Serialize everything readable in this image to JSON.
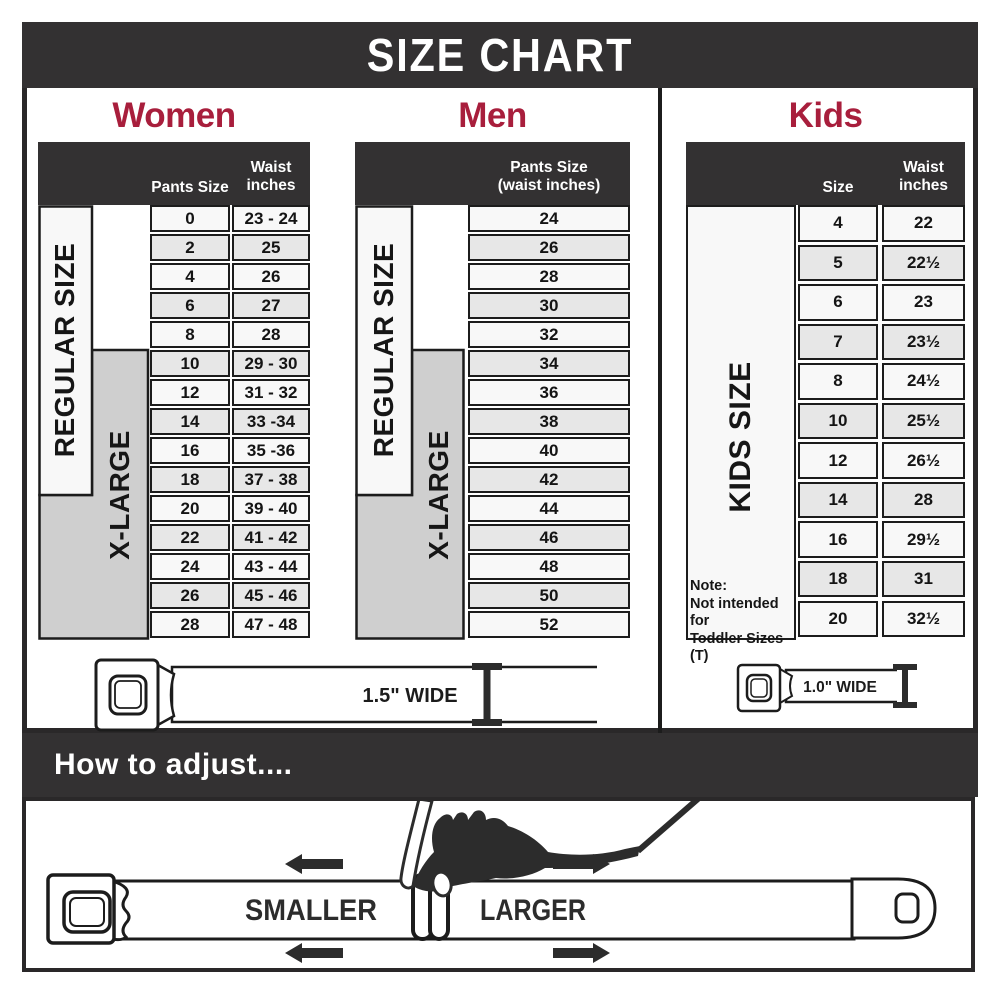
{
  "title": "SIZE CHART",
  "colors": {
    "accent": "#a81e3c",
    "band_dark": "#333132",
    "table_border": "#1c1c1c",
    "xlarge_gray": "#cfcfcf"
  },
  "women": {
    "heading": "Women",
    "regular_label": "REGULAR SIZE",
    "xlarge_label": "X-LARGE",
    "col_size_header": "Pants Size",
    "waist_header_line1": "Waist",
    "waist_header_line2": "inches",
    "rows": [
      {
        "size": "0",
        "waist": "23 - 24"
      },
      {
        "size": "2",
        "waist": "25"
      },
      {
        "size": "4",
        "waist": "26"
      },
      {
        "size": "6",
        "waist": "27"
      },
      {
        "size": "8",
        "waist": "28"
      },
      {
        "size": "10",
        "waist": "29 - 30"
      },
      {
        "size": "12",
        "waist": "31 - 32"
      },
      {
        "size": "14",
        "waist": "33 -34"
      },
      {
        "size": "16",
        "waist": "35 -36"
      },
      {
        "size": "18",
        "waist": "37 - 38"
      },
      {
        "size": "20",
        "waist": "39 - 40"
      },
      {
        "size": "22",
        "waist": "41 - 42"
      },
      {
        "size": "24",
        "waist": "43 - 44"
      },
      {
        "size": "26",
        "waist": "45 - 46"
      },
      {
        "size": "28",
        "waist": "47 - 48"
      }
    ]
  },
  "men": {
    "heading": "Men",
    "regular_label": "REGULAR SIZE",
    "xlarge_label": "X-LARGE",
    "header_line1": "Pants Size",
    "header_line2": "(waist inches)",
    "rows": [
      "24",
      "26",
      "28",
      "30",
      "32",
      "34",
      "36",
      "38",
      "40",
      "42",
      "44",
      "46",
      "48",
      "50",
      "52"
    ]
  },
  "kids": {
    "heading": "Kids",
    "side_label": "KIDS SIZE",
    "col_size_header": "Size",
    "waist_header_line1": "Waist",
    "waist_header_line2": "inches",
    "note_lines": [
      "Note:",
      "Not intended for",
      "Toddler Sizes (T)"
    ],
    "rows": [
      {
        "size": "4",
        "waist": "22"
      },
      {
        "size": "5",
        "waist": "22½"
      },
      {
        "size": "6",
        "waist": "23"
      },
      {
        "size": "7",
        "waist": "23½"
      },
      {
        "size": "8",
        "waist": "24½"
      },
      {
        "size": "10",
        "waist": "25½"
      },
      {
        "size": "12",
        "waist": "26½"
      },
      {
        "size": "14",
        "waist": "28"
      },
      {
        "size": "16",
        "waist": "29½"
      },
      {
        "size": "18",
        "waist": "31"
      },
      {
        "size": "20",
        "waist": "32½"
      }
    ]
  },
  "belts": {
    "adult_width_label": "1.5\" WIDE",
    "kids_width_label": "1.0\" WIDE"
  },
  "adjust": {
    "heading": "How to adjust....",
    "smaller": "SMALLER",
    "larger": "LARGER"
  }
}
